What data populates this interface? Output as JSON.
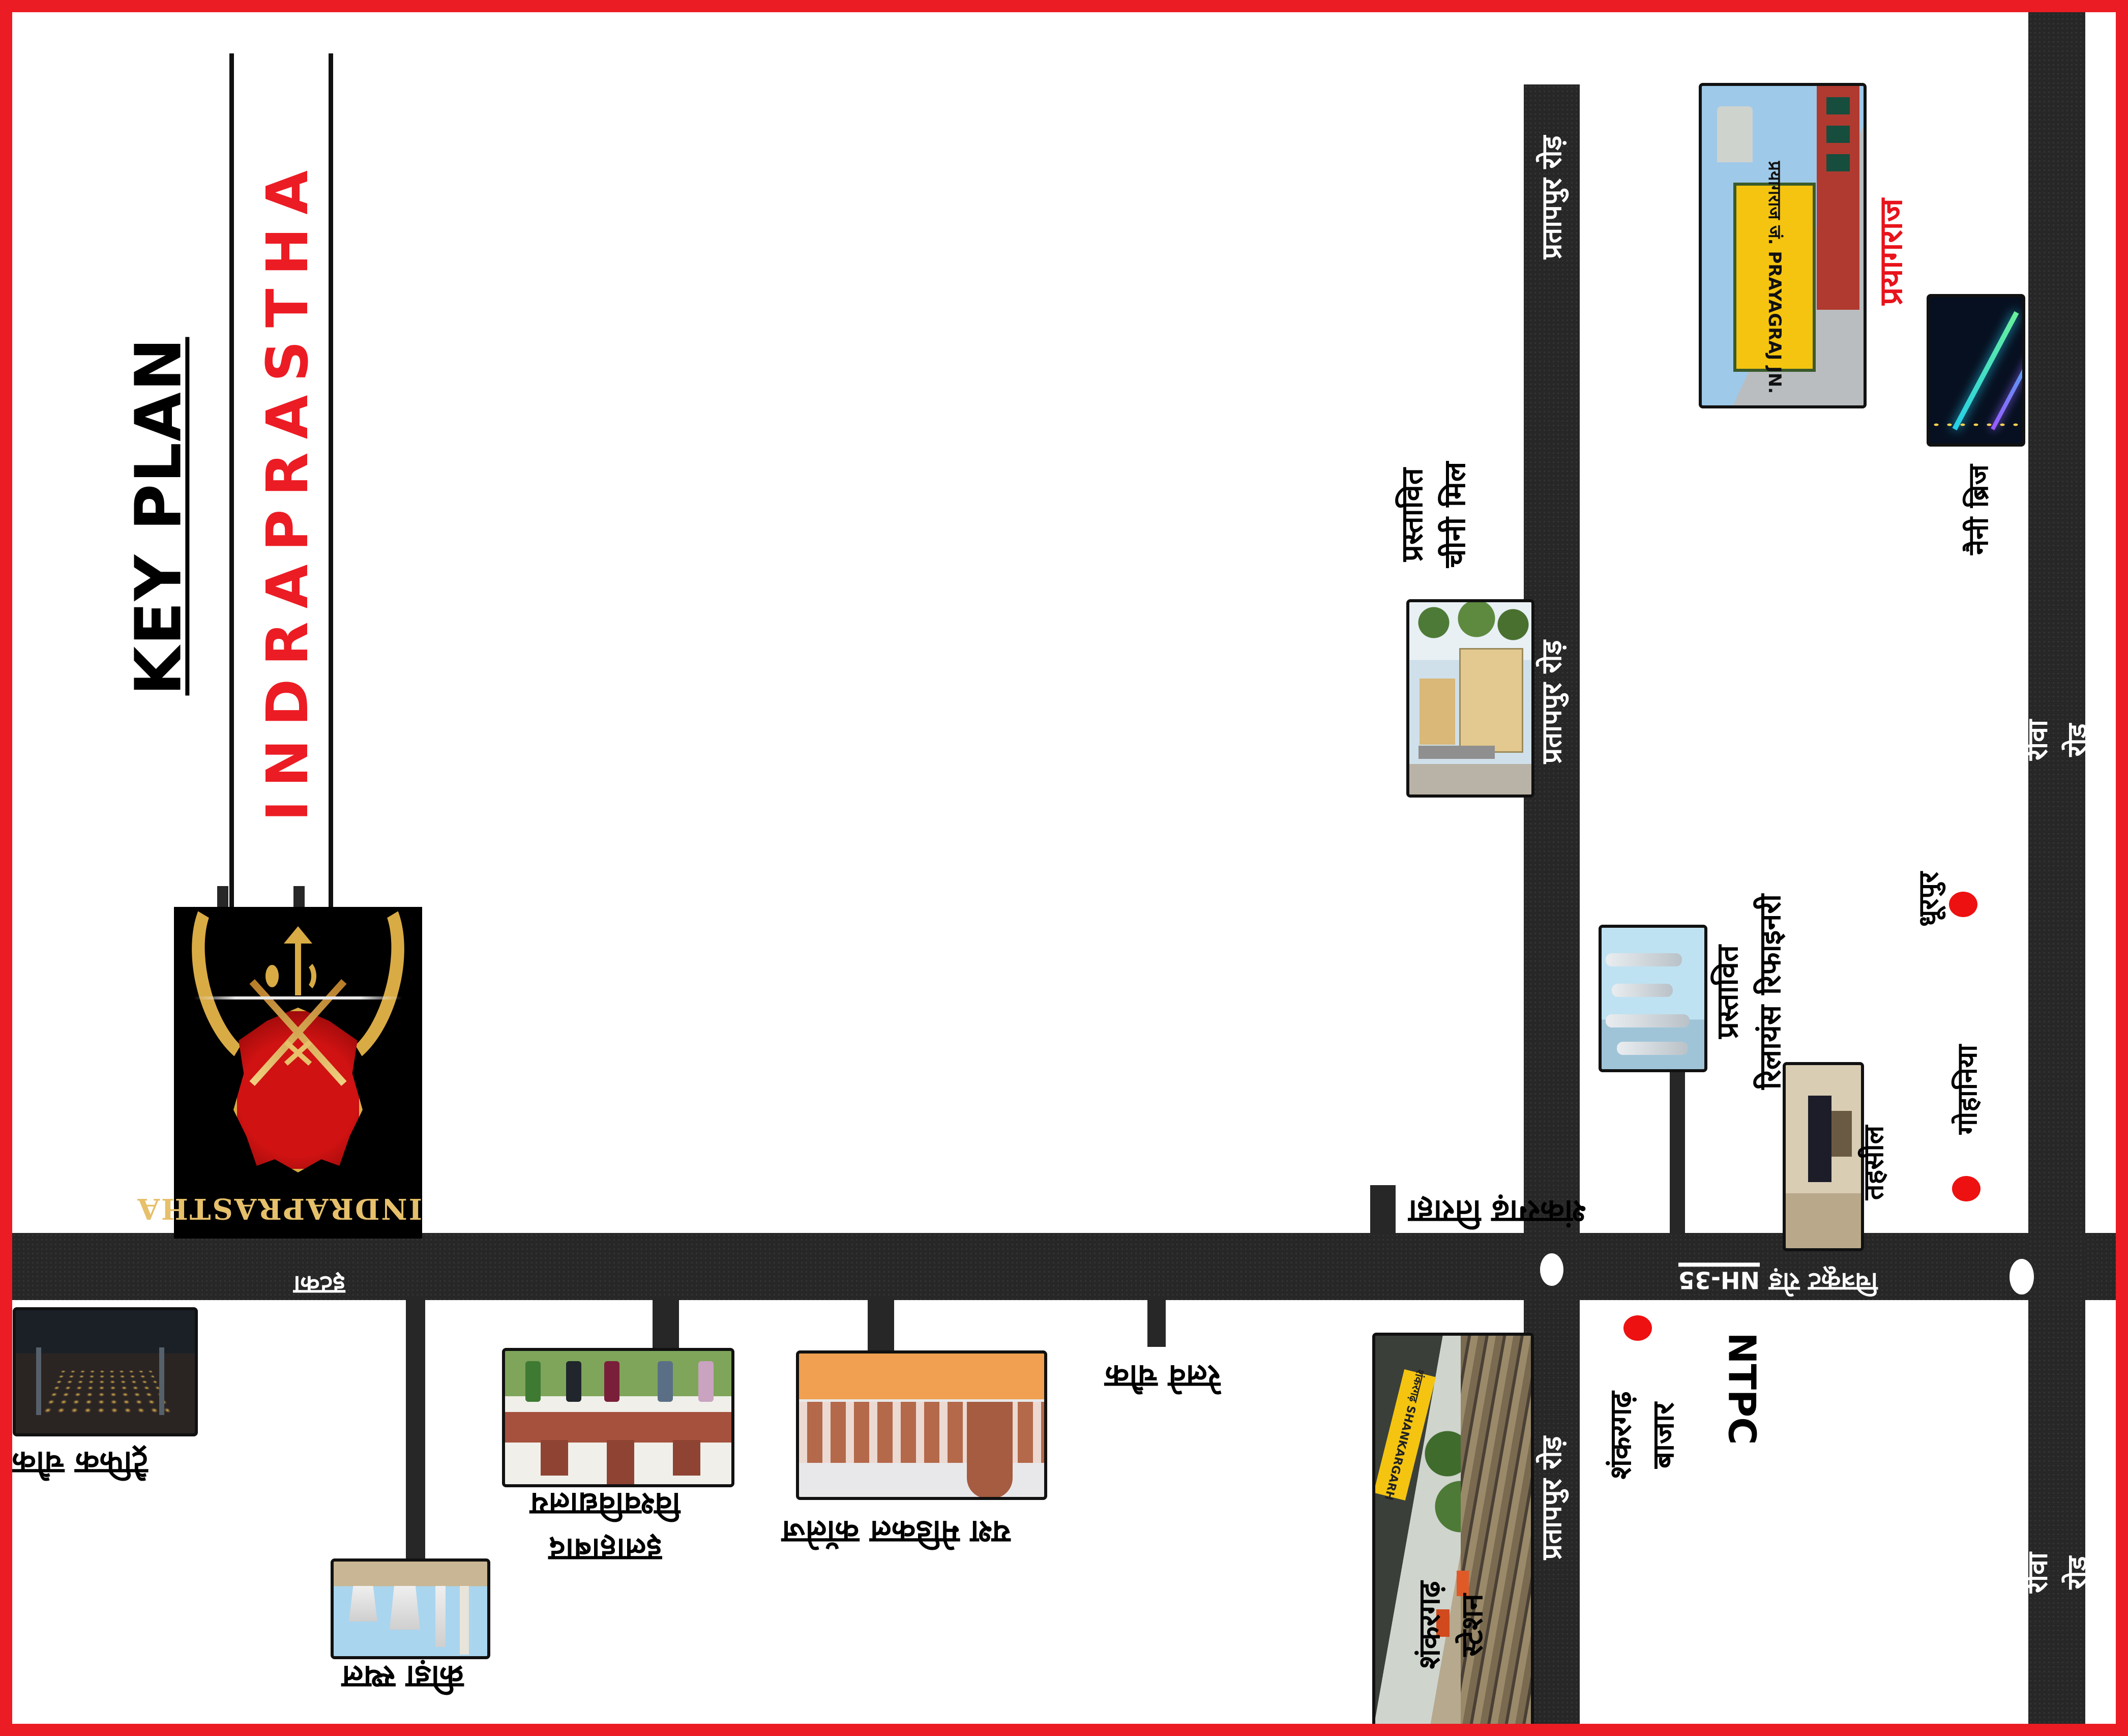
{
  "title": {
    "key_plan": "KEY PLAN",
    "brand": "INDRAPRASTHA"
  },
  "logo": {
    "brand_text": "INDRAPRASTHA"
  },
  "roads": {
    "nh35": "NH-35",
    "chitrakoot_road": "चित्रकूट रोड़",
    "pratappur_road": "प्रतापपुर रोड़",
    "rewa_road": "रीवा रोड",
    "village_on_road": "इटका"
  },
  "places": {
    "prayagraj": "प्रयागराज",
    "naini_bridge": "नैनी ब्रिज",
    "dhurpur": "धूरपुर",
    "gohaniya": "गोहानिया",
    "tehsil": "तहसील",
    "ntpc": "NTPC",
    "shankargarh_bazaar": "शंकरगढ़\nबाजार",
    "shankargarh_station": "शंकरगढ़\nस्टेशन",
    "proposed_sugar_mill": "प्रस्तावित\nचीनी मिल",
    "proposed_reliance_refinery": "प्रस्तावित\nरिलायंस रिफाइनरी",
    "allahabad_university": "इलाहाबाद\nविश्वविद्यालय",
    "medical_college": "यश मेडिकल कॉलेज",
    "sports_ground": "क्रीड़ा स्थल",
    "traffic_chowk": "ट्रैफिक चौक",
    "railway_chowk": "रेलवे चौक",
    "shankargarh_tiraha": "शंकरगढ़ तिराहा"
  },
  "photo_texts": {
    "prayagraj_board": "प्रयागराज जं.\nPRAYAGRAJ JN.",
    "station_board": "शंकरगढ़ SHANKARGARH"
  },
  "colors": {
    "border_red": "#ec1c24",
    "brand_red": "#e8131b",
    "road_black": "#272727",
    "dot_red": "#ee1111"
  }
}
